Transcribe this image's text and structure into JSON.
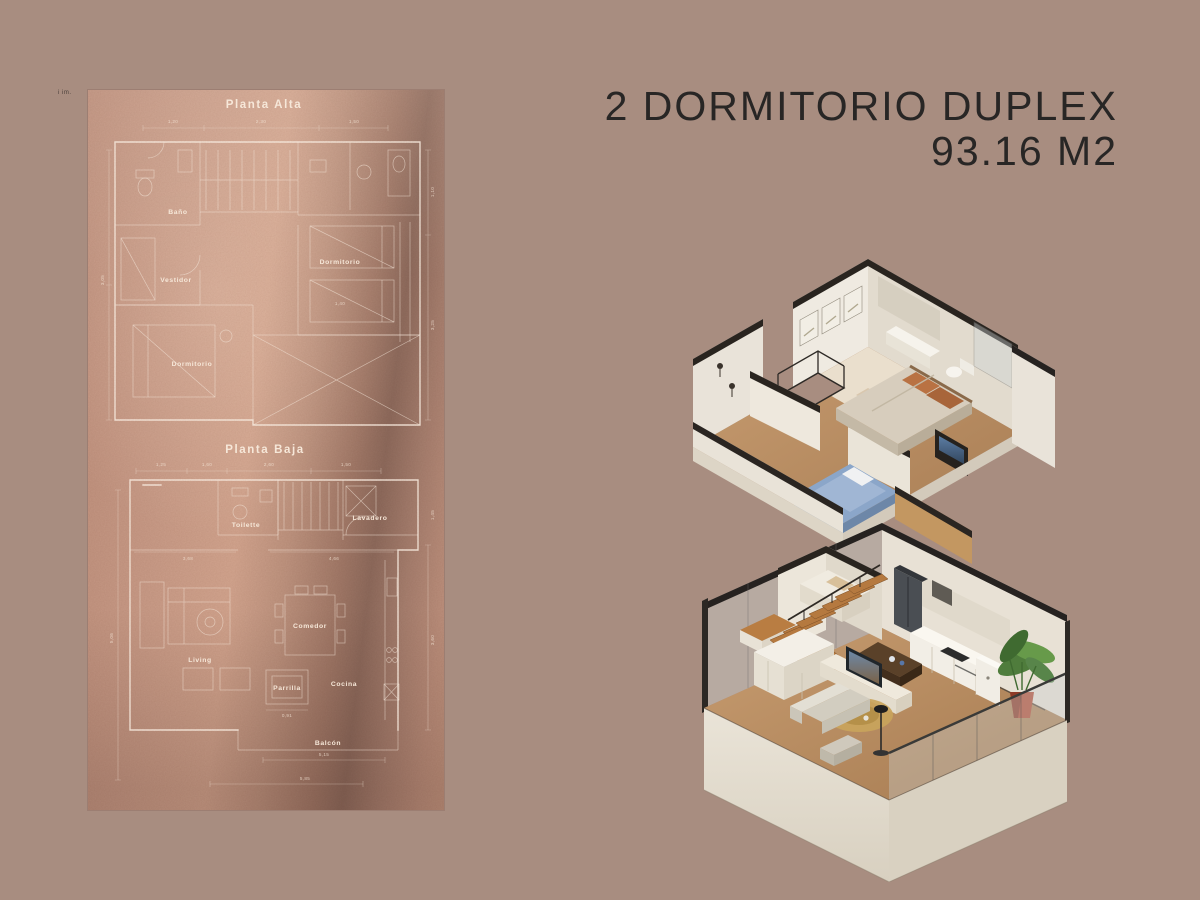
{
  "page": {
    "background": "#a88d80"
  },
  "header": {
    "line1": "2 DORMITORIO DUPLEX",
    "line2": "93.16 M2",
    "text_color": "#282625"
  },
  "watermark": {
    "text": "i im."
  },
  "blueprint": {
    "panel_base_color": "#c99c88",
    "line_color": "#fcf0e5",
    "alta": {
      "title": "Planta Alta",
      "rooms": {
        "bano": "Baño",
        "vestidor": "Vestidor",
        "dormitorio_1": "Dormitorio",
        "dormitorio_2": "Dormitorio"
      },
      "dims_top": [
        "1,20",
        "2,30",
        "1,50"
      ],
      "dims_left": [
        "3,05"
      ],
      "dims_right": [
        "1,10",
        "3,25"
      ],
      "dim_bed": "1,40"
    },
    "baja": {
      "title": "Planta Baja",
      "rooms": {
        "toilette": "Toilette",
        "lavadero": "Lavadero",
        "comedor": "Comedor",
        "living": "Living",
        "cocina": "Cocina",
        "parrilla": "Parrilla",
        "balcon": "Balcón"
      },
      "dims_top": [
        "1,25",
        "1,60",
        "2,60",
        "1,50"
      ],
      "dims_mid": [
        "3,68",
        "4,66"
      ],
      "dims_bottom": [
        "5,15",
        "5,85"
      ],
      "dims_left": [
        "5,06"
      ],
      "dims_right": [
        "1,45",
        "3,60"
      ],
      "dim_parrilla": "0,91"
    }
  },
  "renders": {
    "upper_floor_name": "Planta Alta 3D",
    "lower_floor_name": "Planta Baja 3D",
    "colors": {
      "cut_wall_cap": "#29241f",
      "wall_light": "#ece7df",
      "wall_shade": "#ded7cb",
      "wood_floor": "#bb9065",
      "stairs_wood": "#b5793f",
      "bed_blue": "#8ba6c9",
      "pillow_rust": "#b97243",
      "plant_green": "#4f7c3c",
      "pot_red": "#b44c34",
      "tv_screen": "#46617d",
      "glass": "#cdd1d0"
    }
  }
}
